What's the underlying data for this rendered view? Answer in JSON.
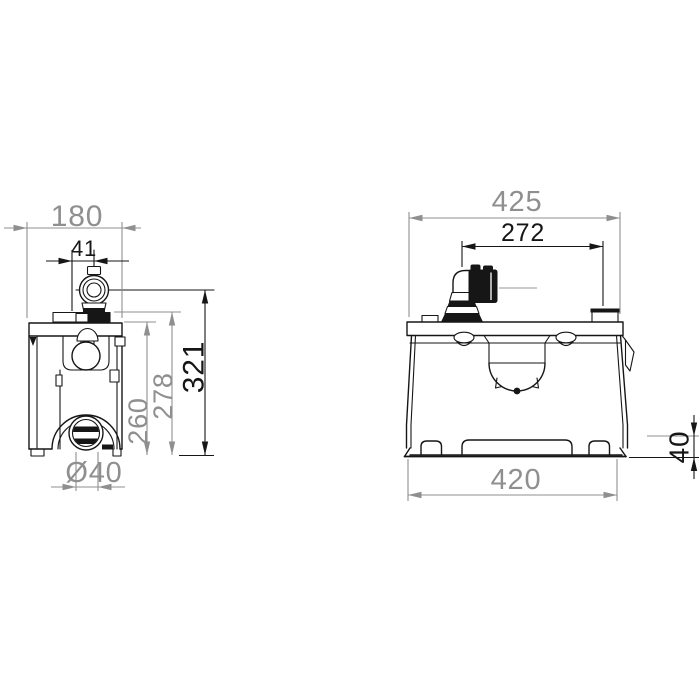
{
  "drawing": {
    "background_color": "#ffffff",
    "line_color": "#161616",
    "dim_gray_color": "#8f8f8f",
    "dim_black_color": "#161616",
    "views": {
      "side_view": {
        "dimensions": {
          "overall_depth": "180",
          "inlet_center_offset": "41",
          "inlet_height": "321",
          "top_height": "278",
          "body_height": "260",
          "outlet_diameter": "Ø40"
        }
      },
      "front_view": {
        "dimensions": {
          "overall_width": "425",
          "inlet_to_vent_spacing": "272",
          "base_width": "420",
          "base_height": "40"
        }
      }
    }
  }
}
